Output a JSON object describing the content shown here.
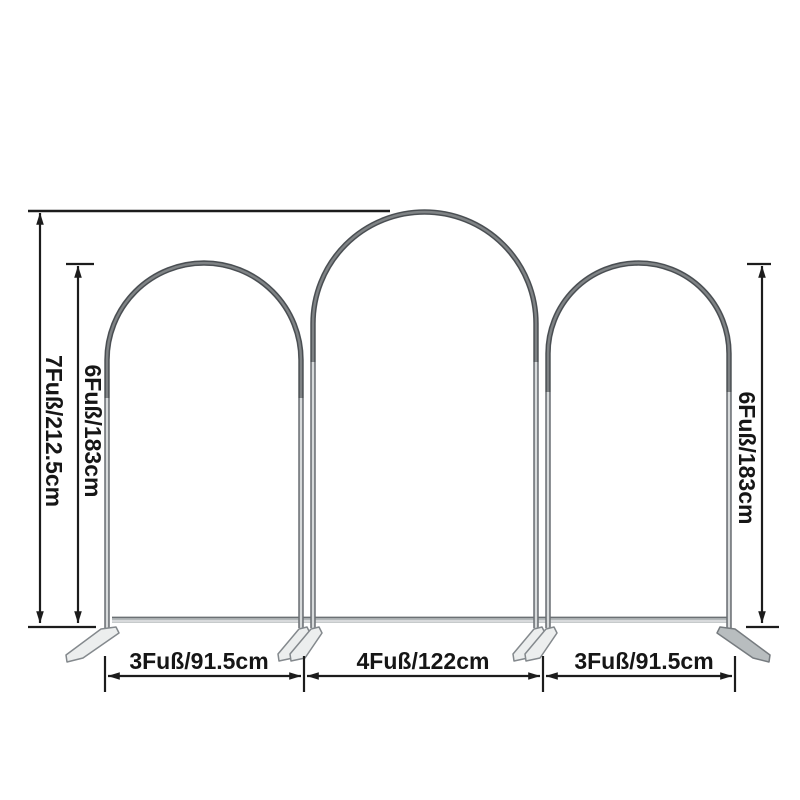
{
  "diagram": {
    "name": "arch-backdrop-stand-dimension-diagram",
    "colors": {
      "background": "#ffffff",
      "dimension_line": "#1c1c1c",
      "frame_tube_dark": "#6a6f73",
      "frame_tube_light": "#d7dadb",
      "foot_fill": "#eceeee"
    },
    "dimensions": {
      "total_height": "7Fuß/212.5cm",
      "left_arch_height": "6Fuß/183cm",
      "right_arch_height": "6Fuß/183cm",
      "left_arch_width": "3Fuß/91.5cm",
      "middle_arch_width": "4Fuß/122cm",
      "right_arch_width": "3Fuß/91.5cm"
    }
  }
}
